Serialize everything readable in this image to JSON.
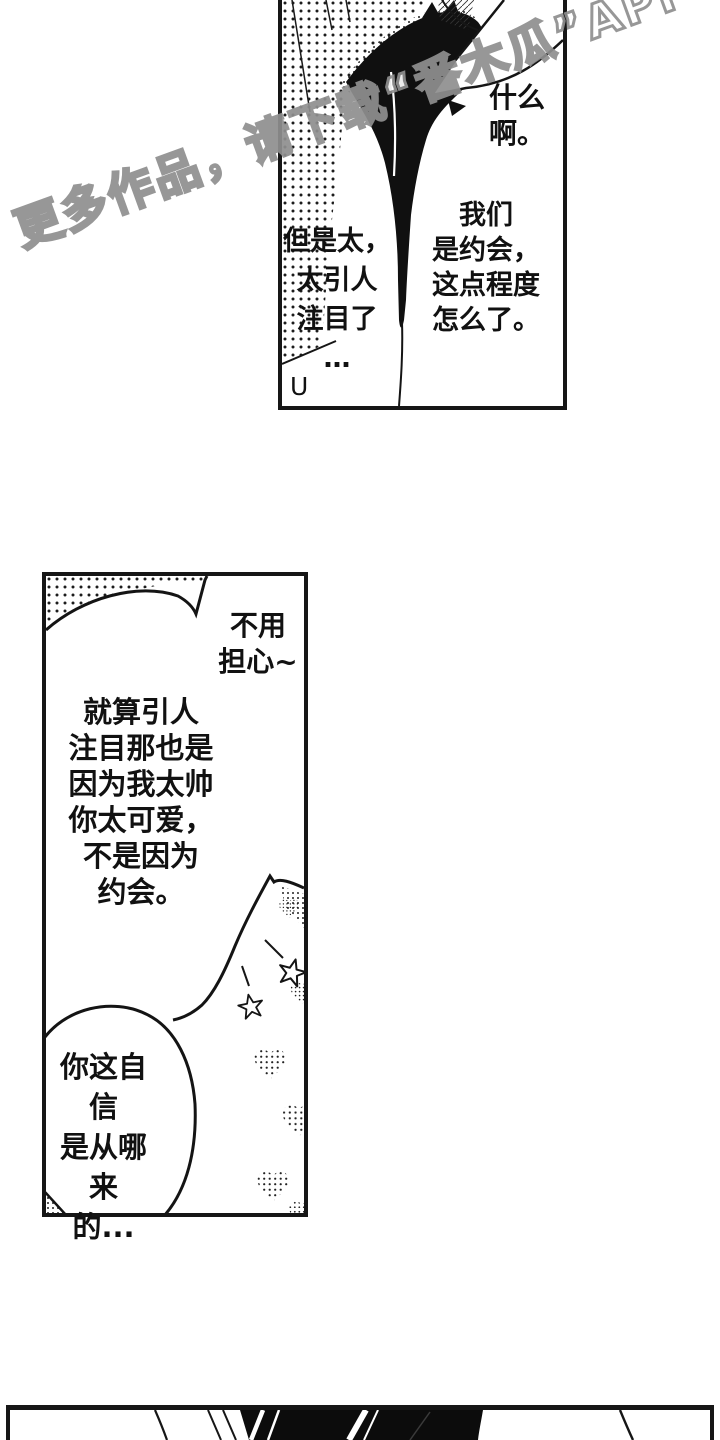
{
  "watermark": {
    "text": "更多作品，请下载“番木瓜”APP"
  },
  "panel1": {
    "speech_right_top": "什么\n啊。",
    "speech_right_main": "我们\n是约会，\n这点程度\n怎么了。",
    "speech_left": "但是太，\n太引人\n注目了\n…",
    "mark": "U"
  },
  "panel2": {
    "speech_top_right": "不用\n担心~",
    "speech_main": "就算引人\n注目那也是\n因为我太帅\n你太可爱，\n不是因为\n约会。",
    "speech_oval": "你这自信\n是从哪来\n的..."
  },
  "colors": {
    "ink": "#161616",
    "paper": "#ffffff",
    "watermark_outline": "#8f8f8f"
  }
}
